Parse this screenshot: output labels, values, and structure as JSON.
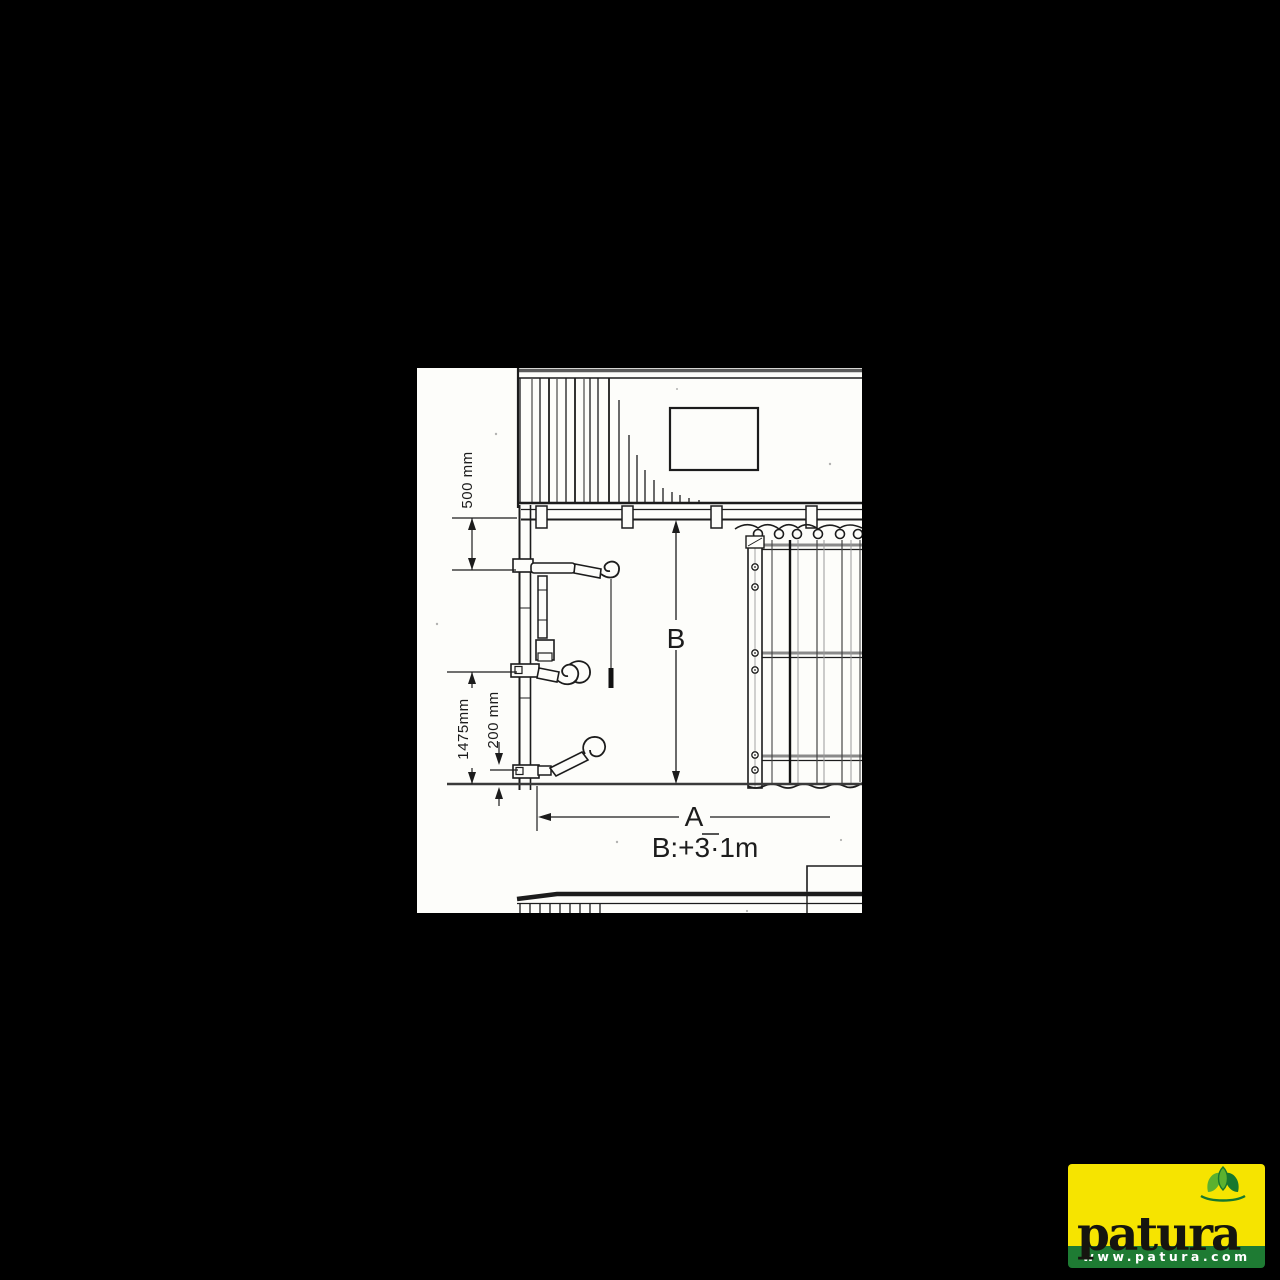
{
  "drawing": {
    "dim_top": "500 mm",
    "dim_side": "1475mm",
    "dim_inner": "200 mm",
    "height_label": "B",
    "width_label": "A",
    "note": "B:+3·1m"
  },
  "logo": {
    "brand": "patura",
    "url": "www.patura.com"
  },
  "colors": {
    "background": "#000000",
    "paper": "#fdfdfa",
    "ink": "#1c1c1c",
    "logo_yellow": "#F6E400",
    "logo_green": "#1E7B33",
    "leaf_light": "#5BB12F",
    "leaf_dark": "#17782E"
  }
}
